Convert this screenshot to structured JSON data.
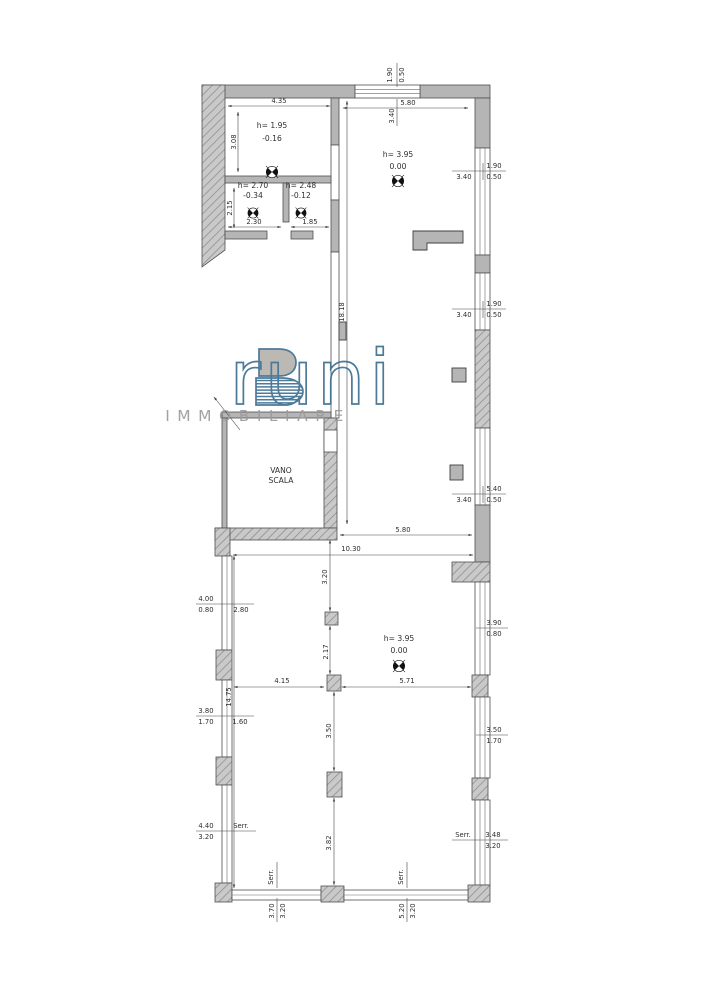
{
  "brand": {
    "name": "Bruni",
    "name_initial": "B",
    "name_rest": "runi",
    "subtitle": "IMMOBILIARE"
  },
  "rooms": {
    "room1": {
      "height": "h= 1.95",
      "level": "-0.16"
    },
    "room2": {
      "height": "h= 2.70",
      "level": "-0.34"
    },
    "room3": {
      "height": "h= 2.48",
      "level": "-0.12"
    },
    "main_upper": {
      "height": "h= 3.95",
      "level": "0.00"
    },
    "stairwell": {
      "line1": "VANO",
      "line2": "SCALA"
    },
    "main_lower": {
      "height": "h= 3.95",
      "level": "0.00"
    }
  },
  "dims": {
    "room1_width": "4.35",
    "room1_depth": "3.08",
    "room2_depth": "2.15",
    "room2_width": "2.30",
    "room3_width": "1.85",
    "top_win_h": "1.90",
    "top_win_sill": "0.50",
    "top_win_w": "3.40",
    "upper_room_w": "5.80",
    "right_win1_h": "1.90",
    "right_win1_sill": "0.50",
    "right_win1_w": "3.40",
    "right_win2_h": "1.90",
    "right_win2_sill": "0.50",
    "right_win2_w": "3.40",
    "right_win3_h": "5.40",
    "right_win3_sill": "0.50",
    "right_win3_w": "3.40",
    "upper_room_len": "18.18",
    "passage_w": "5.80",
    "hall_w": "10.30",
    "hall_len": "14.75",
    "col_top": "3.20",
    "col_gap": "2.17",
    "col_left": "4.15",
    "col_right": "5.71",
    "col_mid": "3.50",
    "col_bot": "3.82",
    "lwin1_w": "4.00",
    "lwin1_sill": "0.80",
    "lwin1_off": "2.80",
    "lwin2_w": "3.80",
    "lwin2_sill": "1.70",
    "lwin2_off": "1.60",
    "lwin3_w": "4.40",
    "lwin3_sill": "3.20",
    "rwin1_w": "3.90",
    "rwin1_sill": "0.80",
    "rwin2_w": "3.50",
    "rwin2_sill": "1.70",
    "rwin3_w": "3.48",
    "rwin3_sill": "3.20",
    "bwin1_w": "3.70",
    "bwin1_sill": "3.20",
    "bwin2_w": "5.20",
    "bwin2_sill": "3.20",
    "shutter": "Serr."
  },
  "colors": {
    "wall_gray": "#b5b5b5",
    "outline": "#4f4f4f",
    "logo_blue": "#3d6f91",
    "logo_gray": "#9b9b9b"
  }
}
